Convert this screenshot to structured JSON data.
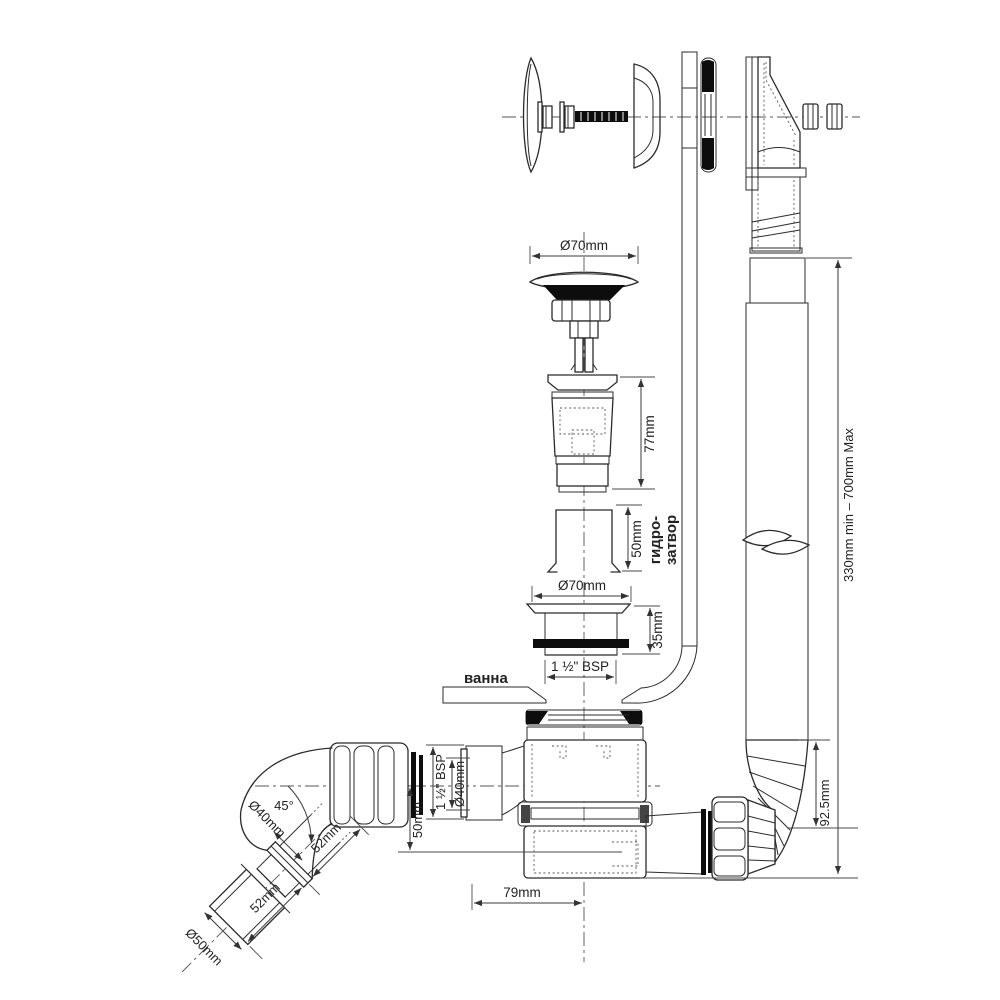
{
  "diagram": {
    "type": "technical-exploded-diagram",
    "subject": "Bath waste, overflow and trap assembly with dimensions",
    "colors": {
      "line": "#2b2b2b",
      "dim": "#3a3a3a",
      "black_fill": "#0d0d0d",
      "background": "#ffffff"
    },
    "labels": {
      "plug_cap_diameter": "Ø70mm",
      "waste_insert_height": "77mm",
      "water_seal_height": "50mm",
      "water_seal_name_line1": "гидро-",
      "water_seal_name_line2": "затвор",
      "waste_flange_diameter": "Ø70mm",
      "waste_thread_height": "35mm",
      "waste_thread_size": "1 ½\" BSP",
      "bath": "ванна",
      "overflow_hose_range": "330mm min – 700mm Max",
      "hose_outlet_drop": "92.5mm",
      "trap_inlet_thread": "1 ½\" BSP",
      "trap_inlet_diameter": "Ø40mm",
      "trap_inlet_depth": "50mm",
      "trap_width": "79mm",
      "elbow_angle": "45°",
      "elbow_pipe_diameter": "Ø40mm",
      "elbow_upper_length": "52mm",
      "elbow_lower_length": "52mm",
      "outlet_pipe_diameter": "Ø50mm"
    }
  }
}
